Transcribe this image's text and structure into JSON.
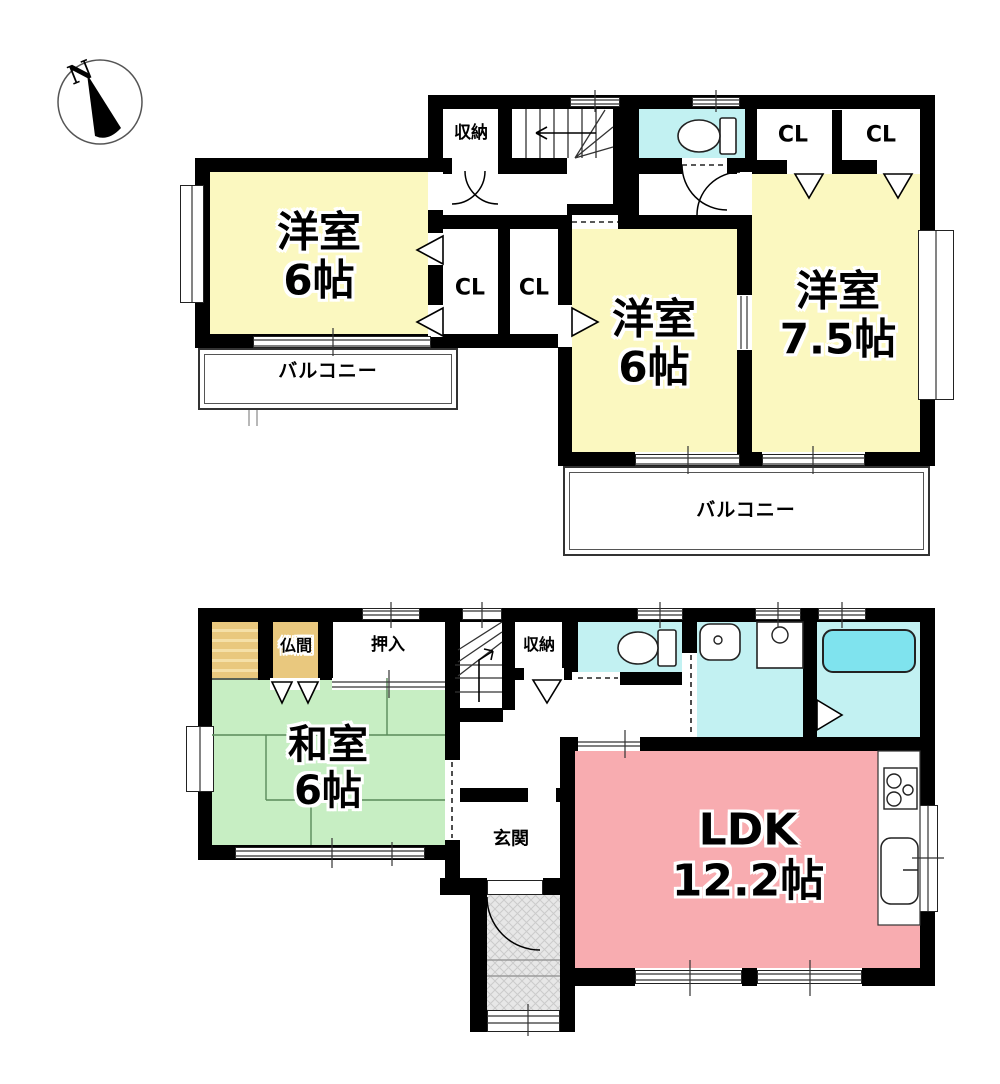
{
  "compass": {
    "north": "N"
  },
  "floor2": {
    "storage_label": "収納",
    "closet_ne_left": "CL",
    "closet_ne_right": "CL",
    "closet_mid_left": "CL",
    "closet_mid_right": "CL",
    "room_west": {
      "name": "洋室",
      "size": "6帖"
    },
    "room_center": {
      "name": "洋室",
      "size": "6帖"
    },
    "room_east": {
      "name": "洋室",
      "size": "7.5帖"
    },
    "balcony_west": "バルコニー",
    "balcony_south": "バルコニー"
  },
  "floor1": {
    "butsuma_label": "仏間",
    "oshiire_label": "押入",
    "storage_label": "収納",
    "washitsu": {
      "name": "和室",
      "size": "6帖"
    },
    "genkan_label": "玄関",
    "ldk": {
      "name": "LDK",
      "size": "12.2帖"
    }
  },
  "colors": {
    "wall": "#000000",
    "room_yellow": "#FBF8C0",
    "room_green": "#C7EEC3",
    "room_pink": "#F8ACB0",
    "wet_cyan": "#C2F1F2",
    "bathtub_cyan": "#7FE3EE",
    "altar_tan": "#E9C87E",
    "porch_gray": "#E7E7E7"
  },
  "icons": {
    "compass-needle-icon": "black needle triangle",
    "toilet-icon": "toilet bowl with tank",
    "sink-icon": "wash basin with faucet dot",
    "washing-machine-icon": "washer pan with circle",
    "bathtub-icon": "rounded bathtub",
    "stove-icon": "three burner cooktop",
    "kitchen-sink-icon": "kitchen sink",
    "stairs-icon": "staircase with direction arrow",
    "door-arc-icon": "door swing arc",
    "folding-door-icon": "triangle door marker"
  }
}
